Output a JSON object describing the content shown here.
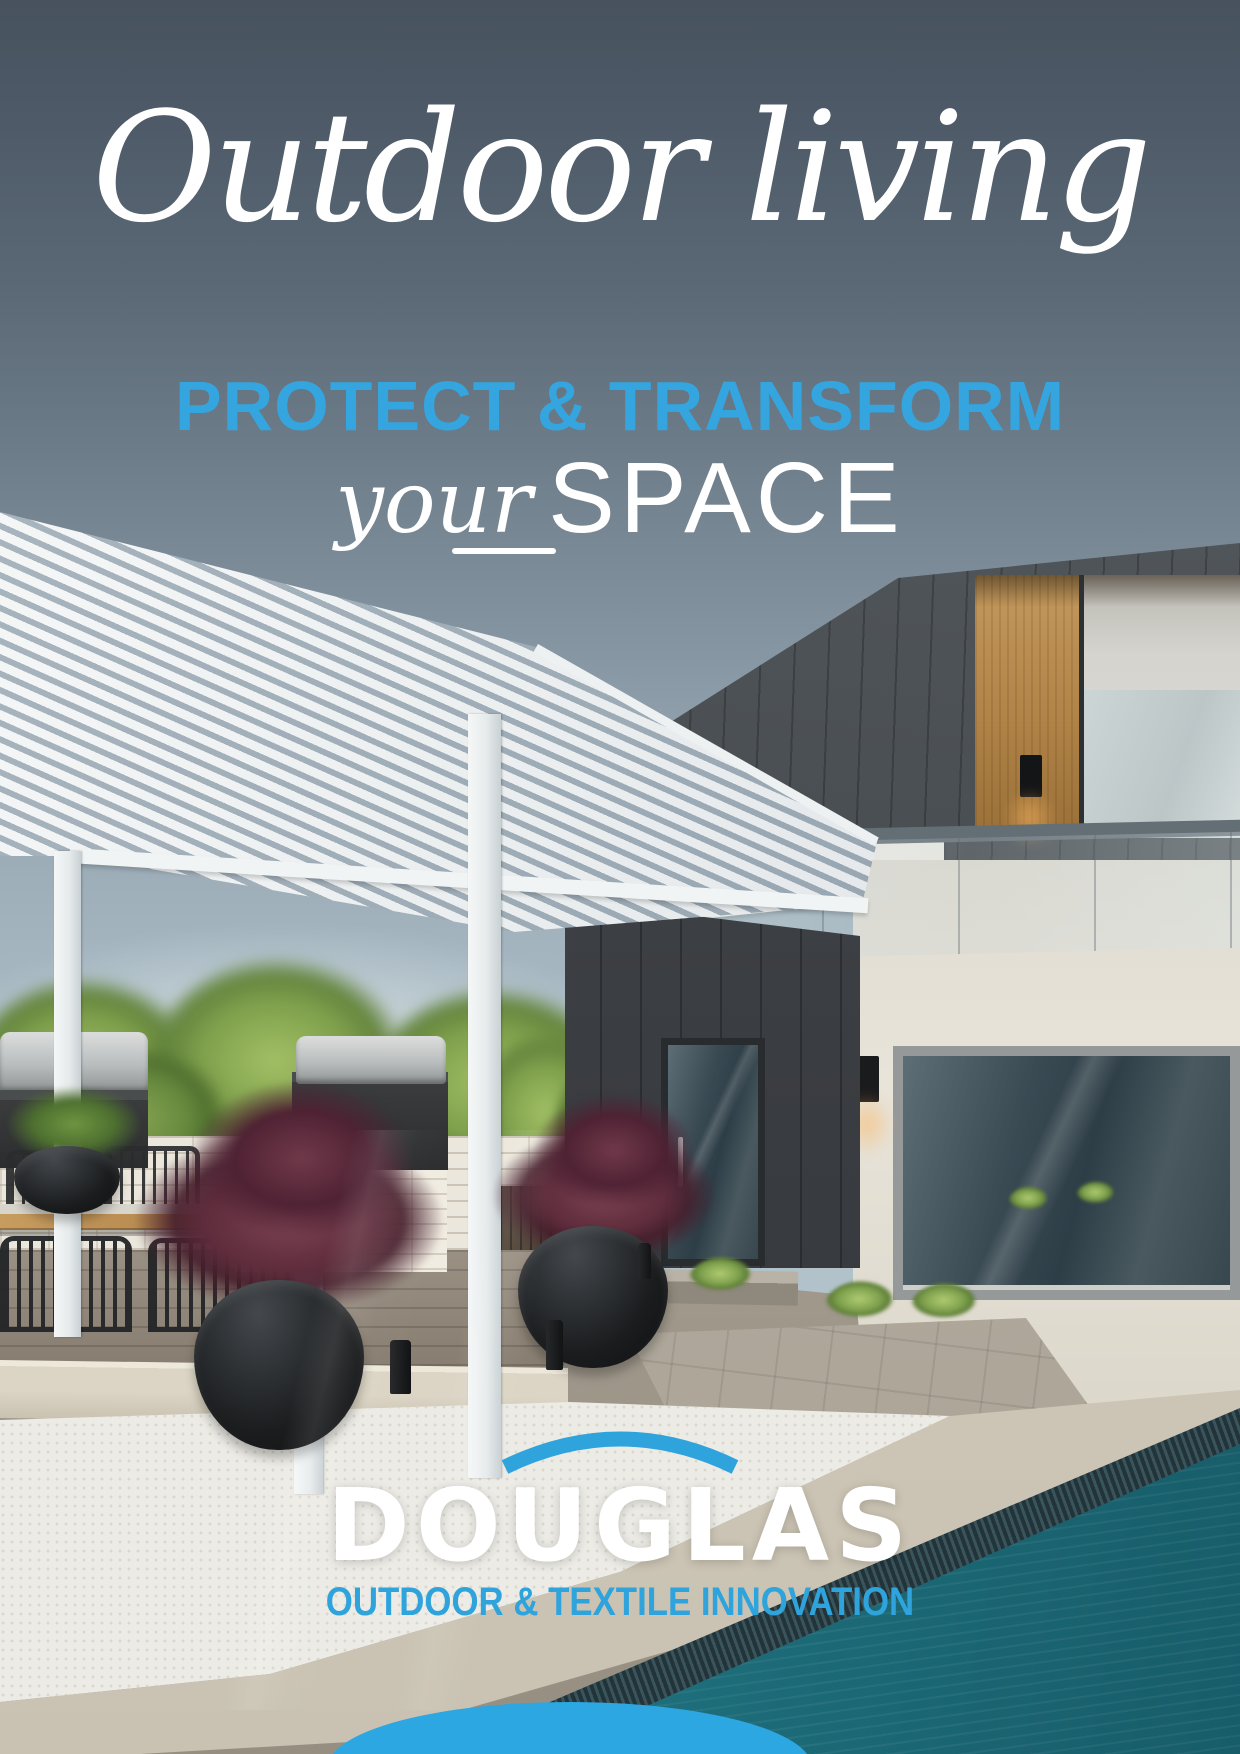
{
  "hero": {
    "title": "Outdoor living",
    "subtitle": "PROTECT & TRANSFORM",
    "script_word": "your",
    "caps_word": "SPACE"
  },
  "logo": {
    "name": "DOUGLAS",
    "tagline": "OUTDOOR & TEXTILE INNOVATION",
    "arc_icon": "swoosh-arc-icon"
  },
  "colors": {
    "accent_blue": "#34A5DF",
    "logo_blue": "#2FA3DC",
    "bottom_ellipse_blue": "#2CA7E2",
    "background_top": "#47525E",
    "sky": "#B4C3CB",
    "pool_teal": "#1E6E7C",
    "text_white": "#FFFFFF"
  }
}
